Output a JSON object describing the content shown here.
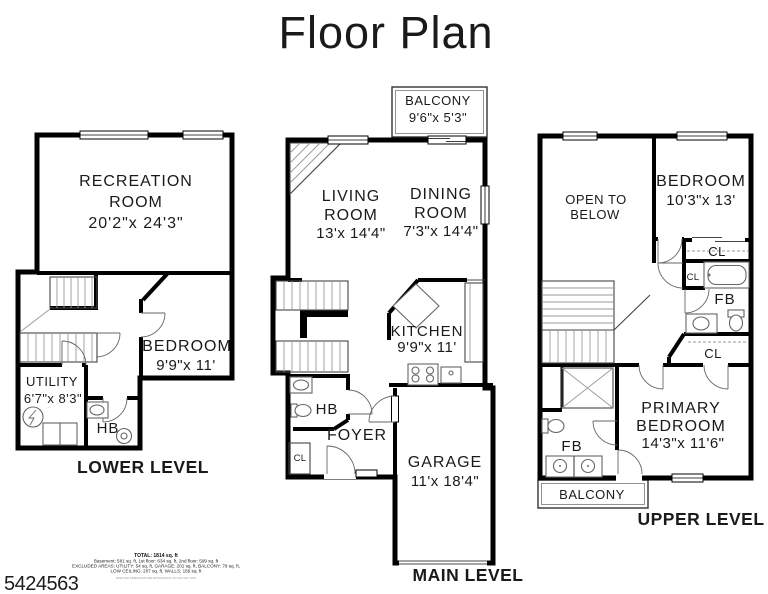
{
  "title": "Floor Plan",
  "colors": {
    "background": "#ffffff",
    "walls": "#000000",
    "text": "#1a1a1a"
  },
  "lower": {
    "level": "LOWER LEVEL",
    "rec1": "RECREATION",
    "rec2": "ROOM",
    "rec_dims": "20'2\"x 24'3\"",
    "bedroom": "BEDROOM",
    "bedroom_dims": "9'9\"x 11'",
    "utility": "UTILITY",
    "utility_dims": "6'7\"x 8'3\"",
    "hb": "HB"
  },
  "main": {
    "level": "MAIN LEVEL",
    "balcony": "BALCONY",
    "balcony_dims": "9'6\"x 5'3\"",
    "living1": "LIVING",
    "living2": "ROOM",
    "living_dims": "13'x 14'4\"",
    "dining1": "DINING",
    "dining2": "ROOM",
    "dining_dims": "7'3\"x 14'4\"",
    "kitchen": "KITCHEN",
    "kitchen_dims": "9'9\"x 11'",
    "hb": "HB",
    "foyer": "FOYER",
    "cl": "CL",
    "garage": "GARAGE",
    "garage_dims": "11'x 18'4\""
  },
  "upper": {
    "level": "UPPER LEVEL",
    "open1": "OPEN TO",
    "open2": "BELOW",
    "bedroom": "BEDROOM",
    "bedroom_dims": "10'3\"x 13'",
    "cl_bedroom": "CL",
    "cl_small": "CL",
    "cl_hall": "CL",
    "fb_upper": "FB",
    "fb_lower": "FB",
    "primary1": "PRIMARY",
    "primary2": "BEDROOM",
    "primary_dims": "14'3\"x 11'6\"",
    "balcony": "BALCONY"
  },
  "footer": {
    "total": "TOTAL: 1814 sq. ft",
    "areas": "Basement: 581 sq. ft, 1st floor: 634 sq. ft, 2nd floor: 599 sq. ft",
    "excluded": "EXCLUDED AREAS: UTILITY: 54 sq. ft, GARAGE: 201 sq. ft, BALCONY: 79 sq. ft,",
    "excluded2": "LOW CEILING: 207 sq. ft, WALLS: 156 sq. ft",
    "disclaimer": "SIZES AND DIMENSIONS ARE APPROXIMATE, ACTUAL MAY VARY",
    "photo_id": "5424563"
  }
}
